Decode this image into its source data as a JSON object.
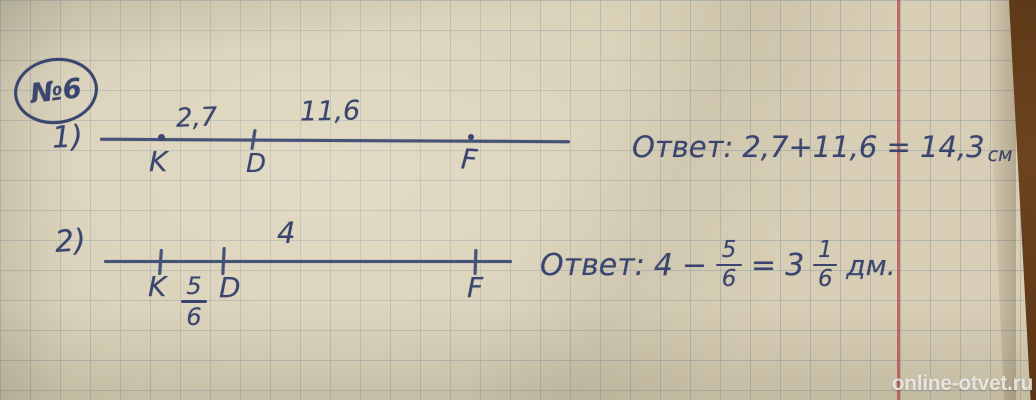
{
  "photo": {
    "watermark": "online-otvet.ru"
  },
  "colors": {
    "paper": "#d7ceb5",
    "grid_line": "#7a929e",
    "ink": "#3a466f",
    "margin_line": "#b14a45",
    "table_edge": "#5e3a18",
    "watermark_text": "#f0f0ee"
  },
  "header": {
    "problem_number": "№6"
  },
  "item1": {
    "index_label": "1)",
    "points": [
      {
        "name": "K"
      },
      {
        "name": "D"
      },
      {
        "name": "F"
      }
    ],
    "segment_labels": [
      {
        "text": "2,7"
      },
      {
        "text": "11,6"
      }
    ],
    "answer": {
      "prefix": "Ответ:",
      "expression": "2,7+11,6 = 14,3",
      "unit": "см"
    }
  },
  "item2": {
    "index_label": "2)",
    "points": [
      {
        "name": "K"
      },
      {
        "name": "D"
      },
      {
        "name": "F"
      }
    ],
    "below_fraction": {
      "numerator": "5",
      "denominator": "6"
    },
    "segment_label": "4",
    "answer": {
      "prefix": "Ответ:",
      "minuend": "4",
      "operator": "−",
      "fraction1": {
        "numerator": "5",
        "denominator": "6"
      },
      "equals": "=",
      "whole": "3",
      "fraction2": {
        "numerator": "1",
        "denominator": "6"
      },
      "unit": "дм."
    }
  }
}
